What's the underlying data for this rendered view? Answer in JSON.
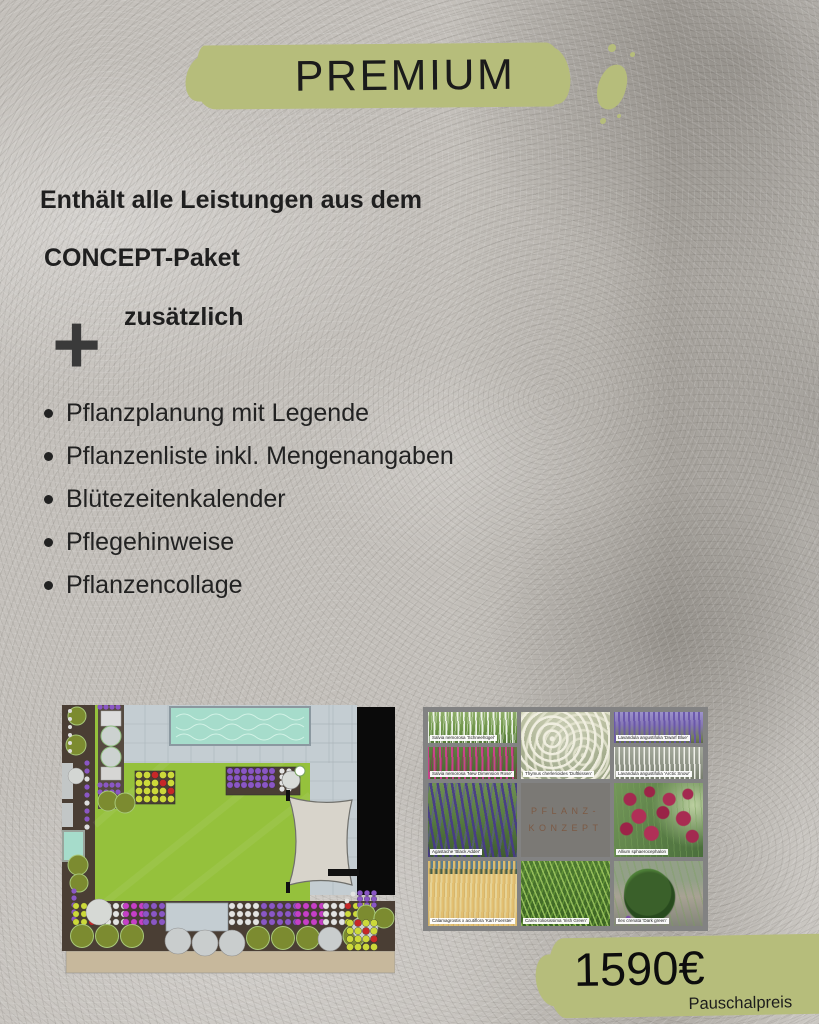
{
  "header": {
    "title": "PREMIUM"
  },
  "intro": {
    "line1": "Enthält alle Leistungen aus dem",
    "line2": "CONCEPT-Paket",
    "plus": "+",
    "additional": "zusätzlich"
  },
  "features": [
    "Pflanzplanung mit Legende",
    "Pflanzenliste inkl. Mengenangaben",
    "Blütezeitenkalender",
    "Pflegehinweise",
    "Pflanzencollage"
  ],
  "pricing": {
    "price": "1590€",
    "note": "Pauschalpreis"
  },
  "plant_concept": {
    "center_title_line1": "PFLANZ-",
    "center_title_line2": "KONZEPT",
    "cells": [
      {
        "name": "salvia-white",
        "label": "Salvia nemorosa 'Schneehügel'"
      },
      {
        "name": "salvia-pink",
        "label": "Salvia nemorosa 'New Dimension Rose'"
      },
      {
        "name": "thymus",
        "label": "Thymus cherlerioides 'Duftkissen'"
      },
      {
        "name": "lavender-dwarf-blue",
        "label": "Lavandula angustifolia 'Dwarf Blue'"
      },
      {
        "name": "lavender-arctic-snow",
        "label": "Lavandula angustifolia 'Arctic Snow'"
      },
      {
        "name": "agastache",
        "label": "Agastache 'Black Adder'"
      },
      {
        "name": "allium",
        "label": "Allium sphaerocephalon"
      },
      {
        "name": "calamagrostis",
        "label": "Calamagrostis x acutiflora 'Karl Foerster'"
      },
      {
        "name": "carex",
        "label": "Carex foliosissima 'Irish Green'"
      },
      {
        "name": "ilex",
        "label": "Ilex crenata 'Dark green'"
      }
    ]
  },
  "colors": {
    "accent_green": "#b6bd7b",
    "text_dark": "#1f1f1f",
    "collage_frame": "#828282",
    "collage_center_bg": "#7b7975",
    "collage_center_text": "#7c5a45",
    "plan": {
      "lawn": "#95c13c",
      "pool": "#a6dccb",
      "paving": "#c4cdd2",
      "soil": "#4a3e34",
      "olive": "#7c8b30",
      "purple": "#8a57c4",
      "magenta": "#c63fc6",
      "yellow_green": "#ccd93a",
      "red": "#c62828",
      "building": "#0a0a0a",
      "sail": "#d8d4cb",
      "base_strip": "#c7b89c"
    }
  }
}
